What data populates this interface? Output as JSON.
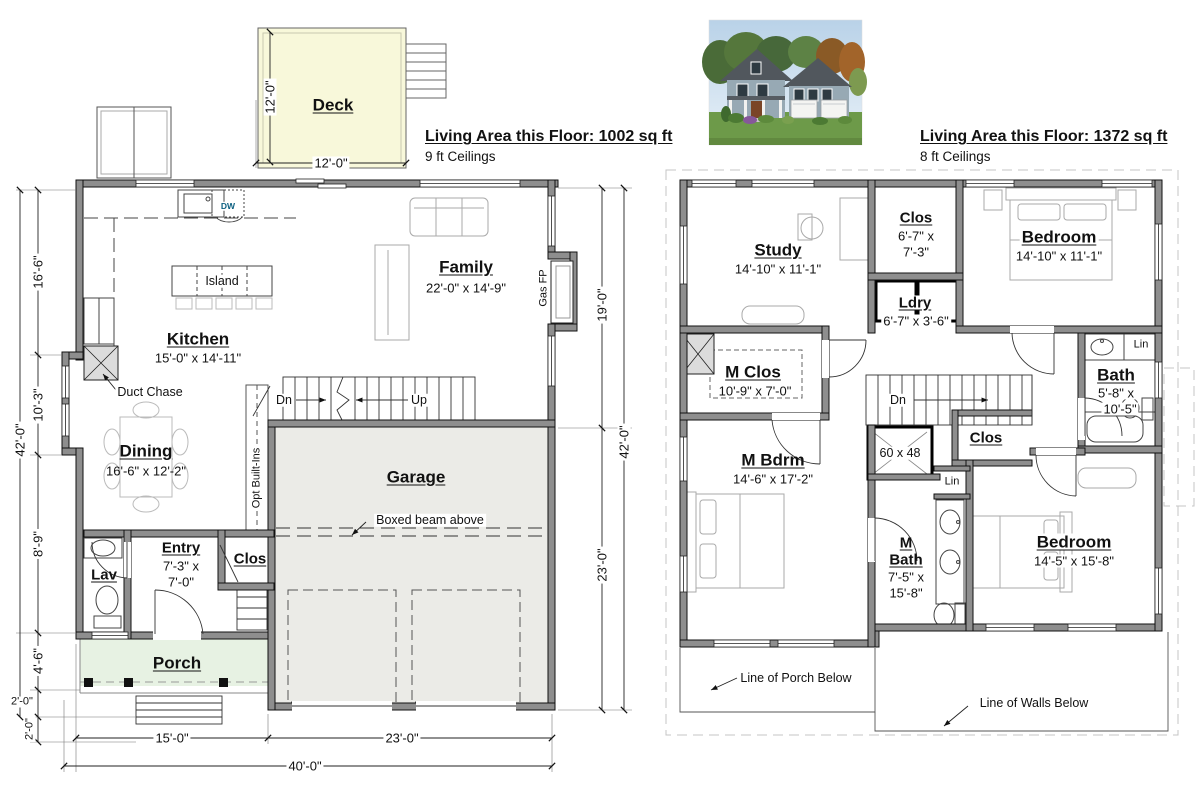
{
  "floor1": {
    "header": {
      "title": "Living Area this Floor: 1002 sq ft",
      "subtitle": "9 ft Ceilings"
    },
    "labels": [
      {
        "name": "room-label-deck",
        "text": "Deck",
        "x": 333,
        "y": 105,
        "cls": "room"
      },
      {
        "name": "dim-deck-height",
        "text": "12'-0\"",
        "x": 270,
        "y": 97,
        "cls": "dim v bg"
      },
      {
        "name": "dim-deck-width",
        "text": "12'-0\"",
        "x": 331,
        "y": 163,
        "cls": "dim bg"
      },
      {
        "name": "room-label-family",
        "text": "Family",
        "x": 466,
        "y": 267,
        "cls": "room"
      },
      {
        "name": "dim-family-size",
        "text": "22'-0\" x 14'-9\"",
        "x": 466,
        "y": 288,
        "cls": "dim"
      },
      {
        "name": "label-gas-fp",
        "text": "Gas FP",
        "x": 544,
        "y": 288,
        "cls": "sm v"
      },
      {
        "name": "room-label-kitchen",
        "text": "Kitchen",
        "x": 198,
        "y": 339,
        "cls": "room"
      },
      {
        "name": "dim-kitchen-size",
        "text": "15'-0\" x 14'-11\"",
        "x": 198,
        "y": 358,
        "cls": "dim"
      },
      {
        "name": "label-island",
        "text": "Island",
        "x": 222,
        "y": 281,
        "cls": "note bg"
      },
      {
        "name": "label-dw",
        "text": "DW",
        "x": 228,
        "y": 206,
        "cls": "dw bg"
      },
      {
        "name": "annotation-duct-chase",
        "text": "Duct Chase",
        "x": 150,
        "y": 392,
        "cls": "note bg"
      },
      {
        "name": "room-label-dining",
        "text": "Dining",
        "x": 146,
        "y": 451,
        "cls": "room"
      },
      {
        "name": "dim-dining-size",
        "text": "16'-6\" x 12'-2\"",
        "x": 146,
        "y": 471,
        "cls": "dim"
      },
      {
        "name": "label-stairs-dn",
        "text": "Dn",
        "x": 284,
        "y": 400,
        "cls": "note bg"
      },
      {
        "name": "label-stairs-up",
        "text": "Up",
        "x": 419,
        "y": 400,
        "cls": "note bg"
      },
      {
        "name": "label-opt-built-ins",
        "text": "Opt Built-Ins",
        "x": 257,
        "y": 478,
        "cls": "sm v bg"
      },
      {
        "name": "room-label-garage",
        "text": "Garage",
        "x": 416,
        "y": 477,
        "cls": "room"
      },
      {
        "name": "annotation-boxed-beam",
        "text": "Boxed beam above",
        "x": 430,
        "y": 520,
        "cls": "note bg"
      },
      {
        "name": "room-label-entry",
        "text": "Entry",
        "x": 181,
        "y": 548,
        "cls": "room-sm"
      },
      {
        "name": "dim-entry-size-1",
        "text": "7'-3\" x",
        "x": 181,
        "y": 566,
        "cls": "dim"
      },
      {
        "name": "dim-entry-size-2",
        "text": "7'-0\"",
        "x": 181,
        "y": 582,
        "cls": "dim"
      },
      {
        "name": "room-label-clos",
        "text": "Clos",
        "x": 250,
        "y": 559,
        "cls": "room-sm"
      },
      {
        "name": "room-label-lav",
        "text": "Lav",
        "x": 104,
        "y": 575,
        "cls": "room-sm"
      },
      {
        "name": "room-label-porch",
        "text": "Porch",
        "x": 177,
        "y": 663,
        "cls": "room"
      },
      {
        "name": "dim-left-16-6",
        "text": "16'-6\"",
        "x": 38,
        "y": 272,
        "cls": "dim v bg"
      },
      {
        "name": "dim-left-42-0",
        "text": "42'-0\"",
        "x": 20,
        "y": 440,
        "cls": "dim v bg"
      },
      {
        "name": "dim-left-10-3",
        "text": "10'-3\"",
        "x": 38,
        "y": 405,
        "cls": "dim v bg"
      },
      {
        "name": "dim-left-8-9",
        "text": "8'-9\"",
        "x": 38,
        "y": 544,
        "cls": "dim v bg"
      },
      {
        "name": "dim-left-4-6",
        "text": "4'-6\"",
        "x": 38,
        "y": 661,
        "cls": "dim v bg"
      },
      {
        "name": "dim-left-2-0-a",
        "text": "2'-0\"",
        "x": 22,
        "y": 702,
        "cls": "sm bg"
      },
      {
        "name": "dim-left-2-0-b",
        "text": "2'-0\"",
        "x": 30,
        "y": 729,
        "cls": "sm v bg"
      },
      {
        "name": "dim-right-19-0",
        "text": "19'-0\"",
        "x": 602,
        "y": 305,
        "cls": "dim v bg"
      },
      {
        "name": "dim-right-42-0",
        "text": "42'-0\"",
        "x": 624,
        "y": 442,
        "cls": "dim v bg"
      },
      {
        "name": "dim-right-23-0",
        "text": "23'-0\"",
        "x": 602,
        "y": 565,
        "cls": "dim v bg"
      },
      {
        "name": "dim-bottom-15-0",
        "text": "15'-0\"",
        "x": 172,
        "y": 738,
        "cls": "dim bg"
      },
      {
        "name": "dim-bottom-23-0",
        "text": "23'-0\"",
        "x": 402,
        "y": 738,
        "cls": "dim bg"
      },
      {
        "name": "dim-bottom-40-0",
        "text": "40'-0\"",
        "x": 305,
        "y": 766,
        "cls": "dim bg"
      }
    ]
  },
  "floor2": {
    "header": {
      "title": "Living Area this Floor: 1372 sq ft",
      "subtitle": "8 ft Ceilings"
    },
    "labels": [
      {
        "name": "room-label-study",
        "text": "Study",
        "x": 778,
        "y": 250,
        "cls": "room"
      },
      {
        "name": "dim-study-size",
        "text": "14'-10\" x 11'-1\"",
        "x": 778,
        "y": 269,
        "cls": "dim"
      },
      {
        "name": "room-label-clos-top",
        "text": "Clos",
        "x": 916,
        "y": 218,
        "cls": "room-sm"
      },
      {
        "name": "dim-clos-top-1",
        "text": "6'-7\" x",
        "x": 916,
        "y": 236,
        "cls": "dim"
      },
      {
        "name": "dim-clos-top-2",
        "text": "7'-3\"",
        "x": 916,
        "y": 252,
        "cls": "dim"
      },
      {
        "name": "room-label-bedroom-tr",
        "text": "Bedroom",
        "x": 1059,
        "y": 237,
        "cls": "room bg"
      },
      {
        "name": "dim-bedroom-tr-size",
        "text": "14'-10\" x 11'-1\"",
        "x": 1059,
        "y": 256,
        "cls": "dim bg"
      },
      {
        "name": "room-label-ldry",
        "text": "Ldry",
        "x": 915,
        "y": 303,
        "cls": "room-sm bg"
      },
      {
        "name": "dim-ldry-size",
        "text": "6'-7\" x 3'-6\"",
        "x": 916,
        "y": 321,
        "cls": "dim bg"
      },
      {
        "name": "room-label-m-clos",
        "text": "M Clos",
        "x": 753,
        "y": 372,
        "cls": "room bg"
      },
      {
        "name": "dim-m-clos-size",
        "text": "10'-9\" x 7'-0\"",
        "x": 755,
        "y": 391,
        "cls": "dim bg"
      },
      {
        "name": "label-stairs2-dn",
        "text": "Dn",
        "x": 898,
        "y": 400,
        "cls": "note bg"
      },
      {
        "name": "label-shower-size",
        "text": "60 x 48",
        "x": 900,
        "y": 453,
        "cls": "note bg"
      },
      {
        "name": "room-label-clos-mid",
        "text": "Clos",
        "x": 986,
        "y": 438,
        "cls": "room-sm bg"
      },
      {
        "name": "label-lin-mid",
        "text": "Lin",
        "x": 952,
        "y": 482,
        "cls": "sm bg"
      },
      {
        "name": "room-label-m-bdrm",
        "text": "M Bdrm",
        "x": 773,
        "y": 460,
        "cls": "room"
      },
      {
        "name": "dim-m-bdrm-size",
        "text": "14'-6\" x 17'-2\"",
        "x": 773,
        "y": 479,
        "cls": "dim"
      },
      {
        "name": "room-label-m-bath-1",
        "text": "M",
        "x": 906,
        "y": 543,
        "cls": "room-sm"
      },
      {
        "name": "room-label-m-bath-2",
        "text": "Bath",
        "x": 906,
        "y": 560,
        "cls": "room-sm"
      },
      {
        "name": "dim-m-bath-1",
        "text": "7'-5\" x",
        "x": 906,
        "y": 577,
        "cls": "dim"
      },
      {
        "name": "dim-m-bath-2",
        "text": "15'-8\"",
        "x": 906,
        "y": 593,
        "cls": "dim"
      },
      {
        "name": "room-label-bedroom-br",
        "text": "Bedroom",
        "x": 1074,
        "y": 542,
        "cls": "room bg"
      },
      {
        "name": "dim-bedroom-br-size",
        "text": "14'-5\" x 15'-8\"",
        "x": 1074,
        "y": 561,
        "cls": "dim bg"
      },
      {
        "name": "room-label-bath",
        "text": "Bath",
        "x": 1116,
        "y": 375,
        "cls": "room bg"
      },
      {
        "name": "dim-bath-1",
        "text": "5'-8\" x",
        "x": 1116,
        "y": 393,
        "cls": "dim bg"
      },
      {
        "name": "dim-bath-2",
        "text": "10'-5\"",
        "x": 1120,
        "y": 409,
        "cls": "dim bg"
      },
      {
        "name": "label-lin-right",
        "text": "Lin",
        "x": 1141,
        "y": 345,
        "cls": "sm bg"
      },
      {
        "name": "annotation-line-of-porch-below",
        "text": "Line of Porch Below",
        "x": 796,
        "y": 678,
        "cls": "note bg"
      },
      {
        "name": "annotation-line-of-walls-below",
        "text": "Line of Walls Below",
        "x": 1034,
        "y": 703,
        "cls": "note bg"
      }
    ]
  },
  "colors": {
    "deck_fill": "#f8f8da",
    "porch_fill": "#e7f2e3",
    "garage_fill": "#ebebe7",
    "dw_color": "#0b5f80",
    "wall_fill": "#8e8e8e"
  }
}
